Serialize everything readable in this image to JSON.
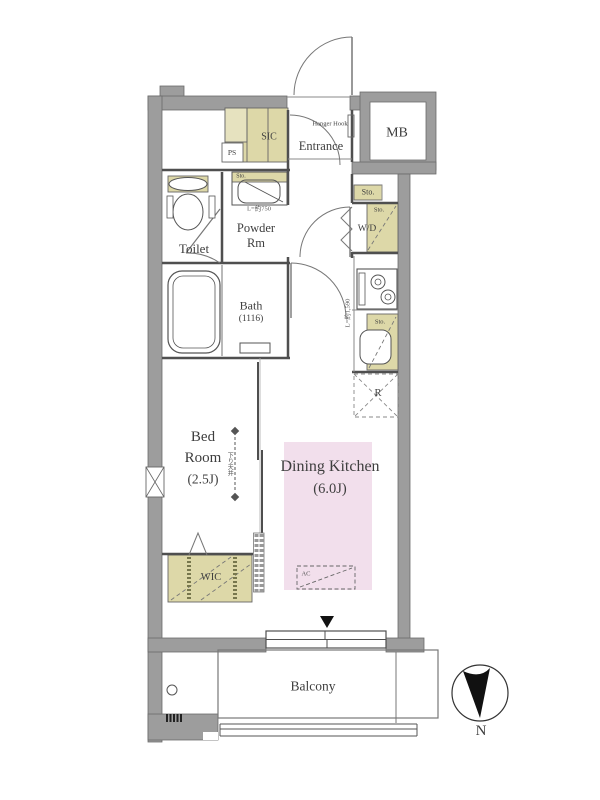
{
  "meta": {
    "type": "apartment-floor-plan",
    "orientation_note": "north arrow points down"
  },
  "colors": {
    "wall_gray": "#9d9d9d",
    "closet_beige": "#ddd8a8",
    "room_pink": "#f2dfec",
    "line": "#4f4f4f",
    "text": "#3e3e3e"
  },
  "labels": {
    "entrance": "Entrance",
    "hanger_hook": "Hanger Hook",
    "mb": "MB",
    "sic": "SIC",
    "ps": "PS",
    "toilet": "Toilet",
    "powder_line1": "Powder",
    "powder_line2": "Rm",
    "powder_sto": "Sto.",
    "powder_counter": "L=約750",
    "bath": "Bath",
    "bath_size": "(1116)",
    "sto_upper": "Sto.",
    "wd": "W/D",
    "wd_sto": "Sto.",
    "kitchen_length": "L=約1,590",
    "kitchen_sto": "Sto.",
    "fridge": "R",
    "bed_line1": "Bed",
    "bed_line2": "Room",
    "bed_size": "(2.5J)",
    "bed_annotation": "下り天井",
    "dk": "Dining Kitchen",
    "dk_size": "(6.0J)",
    "ac": "AC",
    "wic": "WIC",
    "balcony": "Balcony",
    "compass": "N"
  }
}
